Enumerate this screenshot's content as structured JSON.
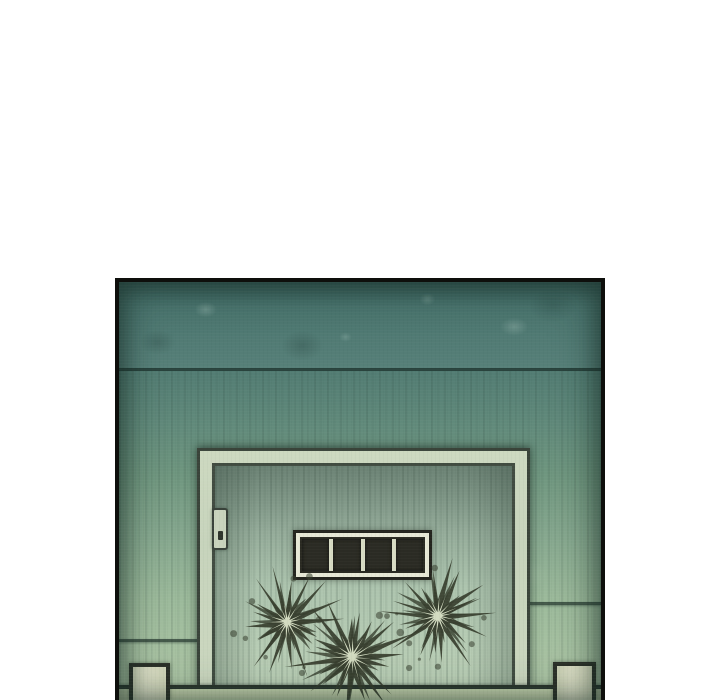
{
  "scene": {
    "alt_text": "Borderless webtoon panel: a weathered teal wall and door drawn in watercolor-pencil style. A darker ceiling band runs across the top. The door has a light frame, a recessed pull on its left edge, and a dark four-slot vent window. Three dark dried starburst plants sit at the base of the door on the floor line, with a short light post at each bottom corner.",
    "panel": {
      "x": 115,
      "y": 278,
      "width": 490,
      "height": 422
    },
    "vent": {
      "slot_count": 4
    },
    "bursts": [
      {
        "cx": 168,
        "cy": 340,
        "r": 46,
        "spikes": 17,
        "seed": 7
      },
      {
        "cx": 233,
        "cy": 375,
        "r": 53,
        "spikes": 19,
        "seed": 13
      },
      {
        "cx": 319,
        "cy": 334,
        "r": 47,
        "spikes": 18,
        "seed": 29
      }
    ]
  },
  "palette": {
    "page-bg": "#ffffff",
    "panel-border": "#0e0f0c",
    "band-top": "#45706a",
    "band-bottom": "#578079",
    "wall-top": "#507a71",
    "wall-mid": "#7da089",
    "wall-bottom": "#abc4a4",
    "seam-line": "#2e423a",
    "frame-face": "#ccd8bf",
    "frame-line": "#3a443a",
    "door-top": "#9cb5a4",
    "door-bottom": "#bdd1b8",
    "vent-frame": "#e7e8d6",
    "vent-slot": "#2b2b24",
    "vent-line": "#24241e",
    "hinge-fill": "#c9d4bd",
    "burst-dark": "#373e2e",
    "burst-light": "#dce5c9",
    "floor-line": "#2c372e",
    "floor": "#c7d5af",
    "post-fill": "#d7dabf",
    "post-line": "#2c3129"
  }
}
